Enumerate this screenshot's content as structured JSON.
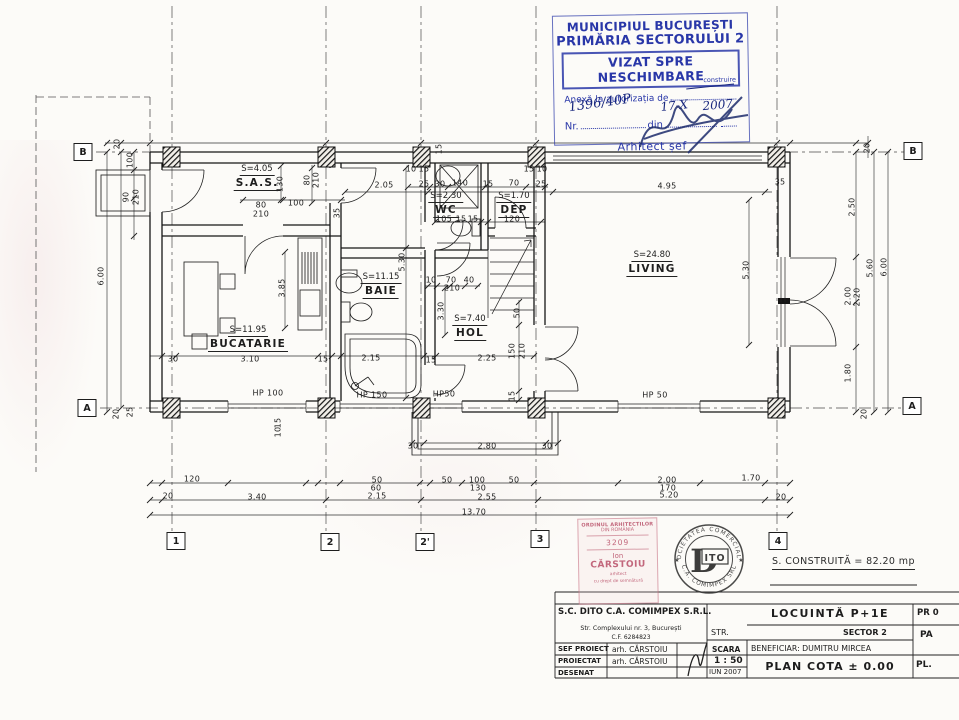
{
  "stamp": {
    "city": "MUNICIPIUL BUCUREȘTI",
    "authority": "PRIMĂRIA SECTORULUI 2",
    "vizat": "VIZAT SPRE NESCHIMBARE",
    "anexa": "Anexă la autorizația de",
    "construire": "construire",
    "nr_label": "Nr.",
    "din_label": "din",
    "nr_value": "1396/40P",
    "date_value": "17-X",
    "year_value": "2007",
    "arhitect": "Arhitect șef",
    "color": "#2937a8"
  },
  "plan": {
    "rooms": [
      {
        "area": "S=4.05",
        "name": "S.A.S.",
        "x": 257,
        "y": 164
      },
      {
        "area": "S=2.30",
        "name": "WC",
        "x": 446,
        "y": 191
      },
      {
        "area": "S=1.70",
        "name": "DEP",
        "x": 514,
        "y": 191
      },
      {
        "area": "S=24.80",
        "name": "LIVING",
        "x": 652,
        "y": 250
      },
      {
        "area": "S=11.15",
        "name": "BAIE",
        "x": 381,
        "y": 272
      },
      {
        "area": "S=7.40",
        "name": "HOL",
        "x": 470,
        "y": 314
      },
      {
        "area": "S=11.95",
        "name": "BUCATARIE",
        "x": 248,
        "y": 325
      }
    ],
    "windows": [
      {
        "label": "HP 100",
        "x": 268,
        "y": 393
      },
      {
        "label": "HP 150",
        "x": 372,
        "y": 395
      },
      {
        "label": "HP50",
        "x": 444,
        "y": 394
      },
      {
        "label": "HP 50",
        "x": 655,
        "y": 395
      }
    ],
    "grid_cols": [
      {
        "label": "1",
        "x": 176,
        "y": 541
      },
      {
        "label": "2",
        "x": 330,
        "y": 542
      },
      {
        "label": "2'",
        "x": 425,
        "y": 542
      },
      {
        "label": "3",
        "x": 540,
        "y": 539
      },
      {
        "label": "4",
        "x": 778,
        "y": 541
      }
    ],
    "grid_rows": [
      {
        "label": "B",
        "x": 83,
        "y": 152
      },
      {
        "label": "B",
        "x": 913,
        "y": 151
      },
      {
        "label": "A",
        "x": 87,
        "y": 408
      },
      {
        "label": "A",
        "x": 912,
        "y": 406
      }
    ],
    "dims": [
      {
        "t": "20",
        "x": 117,
        "y": 144,
        "v": 1
      },
      {
        "t": "100",
        "x": 130,
        "y": 160,
        "v": 1
      },
      {
        "t": "90",
        "x": 126,
        "y": 197,
        "v": 1
      },
      {
        "t": "210",
        "x": 136,
        "y": 197,
        "v": 1
      },
      {
        "t": "6.00",
        "x": 101,
        "y": 276,
        "v": 1
      },
      {
        "t": "20",
        "x": 116,
        "y": 414,
        "v": 1
      },
      {
        "t": "25",
        "x": 130,
        "y": 412,
        "v": 1
      },
      {
        "t": "130",
        "x": 280,
        "y": 184,
        "v": 1
      },
      {
        "t": "80",
        "x": 307,
        "y": 180,
        "v": 1
      },
      {
        "t": "210",
        "x": 316,
        "y": 180,
        "v": 1
      },
      {
        "t": "35",
        "x": 337,
        "y": 213,
        "v": 1
      },
      {
        "t": "80",
        "x": 261,
        "y": 205
      },
      {
        "t": "210",
        "x": 261,
        "y": 214
      },
      {
        "t": "100",
        "x": 296,
        "y": 203
      },
      {
        "t": "2.05",
        "x": 384,
        "y": 185
      },
      {
        "t": "15",
        "x": 439,
        "y": 149,
        "v": 1
      },
      {
        "t": "10",
        "x": 411,
        "y": 169
      },
      {
        "t": "15",
        "x": 424,
        "y": 169
      },
      {
        "t": "25",
        "x": 424,
        "y": 184
      },
      {
        "t": "30",
        "x": 440,
        "y": 184
      },
      {
        "t": "140",
        "x": 460,
        "y": 183
      },
      {
        "t": "15",
        "x": 488,
        "y": 184
      },
      {
        "t": "70",
        "x": 514,
        "y": 183
      },
      {
        "t": "15",
        "x": 529,
        "y": 169
      },
      {
        "t": "10",
        "x": 542,
        "y": 169
      },
      {
        "t": "25",
        "x": 541,
        "y": 184
      },
      {
        "t": "105",
        "x": 444,
        "y": 219
      },
      {
        "t": "15",
        "x": 461,
        "y": 219
      },
      {
        "t": "15",
        "x": 473,
        "y": 219
      },
      {
        "t": "120",
        "x": 512,
        "y": 219
      },
      {
        "t": "4.95",
        "x": 667,
        "y": 186
      },
      {
        "t": "35",
        "x": 780,
        "y": 182
      },
      {
        "t": "20",
        "x": 867,
        "y": 148,
        "v": 1
      },
      {
        "t": "2.50",
        "x": 852,
        "y": 207,
        "v": 1
      },
      {
        "t": "5.60",
        "x": 870,
        "y": 268,
        "v": 1
      },
      {
        "t": "6.00",
        "x": 884,
        "y": 267,
        "v": 1
      },
      {
        "t": "2.00",
        "x": 848,
        "y": 296,
        "v": 1
      },
      {
        "t": "2.20",
        "x": 857,
        "y": 297,
        "v": 1
      },
      {
        "t": "1.80",
        "x": 848,
        "y": 373,
        "v": 1
      },
      {
        "t": "20",
        "x": 864,
        "y": 414,
        "v": 1
      },
      {
        "t": "5.30",
        "x": 746,
        "y": 270,
        "v": 1
      },
      {
        "t": "5.30",
        "x": 402,
        "y": 262,
        "v": 1
      },
      {
        "t": "3.30",
        "x": 441,
        "y": 311,
        "v": 1
      },
      {
        "t": "3.85",
        "x": 282,
        "y": 288,
        "v": 1
      },
      {
        "t": "10",
        "x": 431,
        "y": 280
      },
      {
        "t": "70",
        "x": 451,
        "y": 280
      },
      {
        "t": "40",
        "x": 469,
        "y": 280
      },
      {
        "t": "210",
        "x": 452,
        "y": 288
      },
      {
        "t": "50",
        "x": 517,
        "y": 313,
        "v": 1
      },
      {
        "t": "150",
        "x": 512,
        "y": 351,
        "v": 1
      },
      {
        "t": "210",
        "x": 522,
        "y": 351,
        "v": 1
      },
      {
        "t": "15",
        "x": 512,
        "y": 396,
        "v": 1
      },
      {
        "t": "30",
        "x": 173,
        "y": 359
      },
      {
        "t": "3.10",
        "x": 250,
        "y": 359
      },
      {
        "t": "15",
        "x": 323,
        "y": 359
      },
      {
        "t": "2.15",
        "x": 371,
        "y": 358
      },
      {
        "t": "15",
        "x": 431,
        "y": 360
      },
      {
        "t": "2.25",
        "x": 487,
        "y": 358
      },
      {
        "t": "30",
        "x": 413,
        "y": 446
      },
      {
        "t": "2.80",
        "x": 487,
        "y": 446
      },
      {
        "t": "30",
        "x": 547,
        "y": 446
      },
      {
        "t": "120",
        "x": 192,
        "y": 479
      },
      {
        "t": "20",
        "x": 168,
        "y": 496
      },
      {
        "t": "3.40",
        "x": 257,
        "y": 497
      },
      {
        "t": "50",
        "x": 377,
        "y": 480
      },
      {
        "t": "60",
        "x": 376,
        "y": 488
      },
      {
        "t": "2.15",
        "x": 377,
        "y": 496
      },
      {
        "t": "50",
        "x": 447,
        "y": 480
      },
      {
        "t": "100",
        "x": 477,
        "y": 480
      },
      {
        "t": "130",
        "x": 478,
        "y": 488
      },
      {
        "t": "50",
        "x": 514,
        "y": 480
      },
      {
        "t": "2.55",
        "x": 487,
        "y": 497
      },
      {
        "t": "2.00",
        "x": 667,
        "y": 480
      },
      {
        "t": "170",
        "x": 668,
        "y": 488
      },
      {
        "t": "5.20",
        "x": 669,
        "y": 495
      },
      {
        "t": "1.70",
        "x": 751,
        "y": 478
      },
      {
        "t": "20",
        "x": 781,
        "y": 497
      },
      {
        "t": "13.70",
        "x": 474,
        "y": 512
      },
      {
        "t": "15",
        "x": 278,
        "y": 423,
        "v": 1
      },
      {
        "t": "10",
        "x": 278,
        "y": 432,
        "v": 1
      }
    ]
  },
  "sheet": {
    "area_note": "S. CONSTRUITĂ = 82.20 mp"
  },
  "oar_stamp": {
    "line1": "ORDINUL ARHITECTILOR",
    "line2": "DIN ROMÂNIA",
    "number": "3209",
    "first": "Ion",
    "last": "CĂRSTOIU",
    "small1": "arhitect",
    "small2": "cu drept de semnătură"
  },
  "round_stamp": {
    "top": "SOCIETATEA COMERCIALĂ",
    "bottom": "C.A. COMIMPEX SRL",
    "d": "D",
    "ito": "ITO",
    "star_left": "★",
    "star_right": "★"
  },
  "title_block": {
    "company": "S.C. DITO C.A. COMIMPEX S.R.L.",
    "address": "Str. Complexului nr. 3, București",
    "cf": "C.F. 6284823",
    "rows": [
      {
        "role": "SEF PROIECT",
        "name": "arh. CĂRSTOIU"
      },
      {
        "role": "PROIECTAT",
        "name": "arh. CĂRSTOIU"
      },
      {
        "role": "DESENAT",
        "name": ""
      }
    ],
    "scara_label": "SCARA",
    "scara_value": "1 : 50",
    "date": "IUN 2007",
    "project": "LOCUINTĂ P+1E",
    "str_label": "STR.",
    "sector": "SECTOR 2",
    "beneficiar": "BENEFICIAR: DUMITRU MIRCEA",
    "plansa": "PLAN COTA ± 0.00",
    "pr": "PR 0",
    "pa": "PA",
    "pl": "PL."
  }
}
